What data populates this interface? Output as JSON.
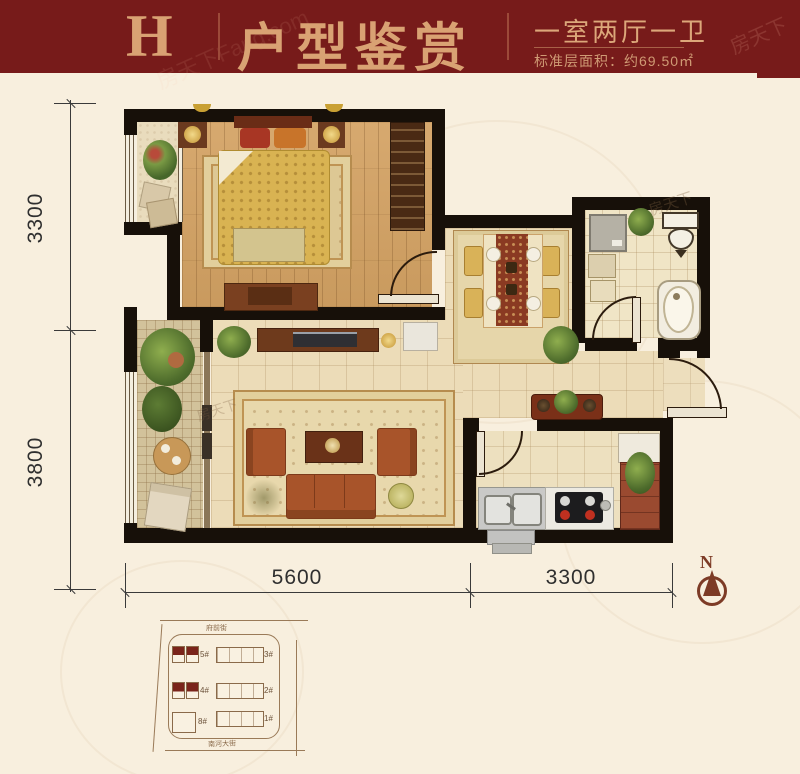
{
  "header": {
    "unit_letter": "H",
    "title": "户型鉴赏",
    "layout_type": "一室两厅一卫",
    "area_text": "标准层面积：约69.50㎡",
    "bg_color": "#771b1a",
    "accent_color": "#d9a273"
  },
  "watermarks": {
    "header_left": "房天下Fang.com",
    "header_right": "房天下",
    "plan_a": "房天下",
    "plan_b": "房天下"
  },
  "plan": {
    "wall_color": "#171009",
    "dims": {
      "left_top": "3300",
      "left_bottom": "3800",
      "bottom_left": "5600",
      "bottom_right": "3300"
    },
    "compass": "N"
  },
  "siteplan": {
    "street_top": "府前街",
    "street_bottom": "南河大街",
    "buildings": [
      {
        "label": "5#",
        "highlight": true
      },
      {
        "label": "3#",
        "highlight": false
      },
      {
        "label": "4#",
        "highlight": true
      },
      {
        "label": "2#",
        "highlight": false
      },
      {
        "label": "8#",
        "highlight": false
      },
      {
        "label": "1#",
        "highlight": false
      }
    ]
  }
}
